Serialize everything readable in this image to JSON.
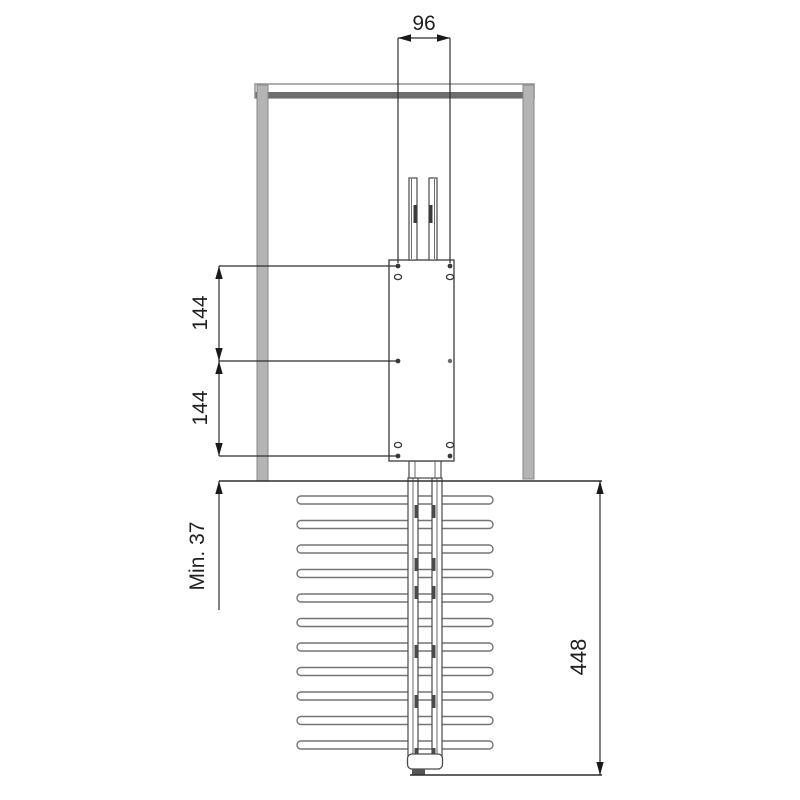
{
  "drawing": {
    "dimensions": {
      "top_hole_spacing": "96",
      "upper_hole_spacing": "144",
      "lower_hole_spacing": "144",
      "min_clearance": "Min. 37",
      "rack_height": "448"
    },
    "colors": {
      "frame_gray": "#b4b4b4",
      "frame_dark_band": "#6f6f6f",
      "outline": "#4a4a4a",
      "dimension_line": "#2e2e2e",
      "text": "#1f1f1f",
      "background": "#ffffff"
    }
  }
}
